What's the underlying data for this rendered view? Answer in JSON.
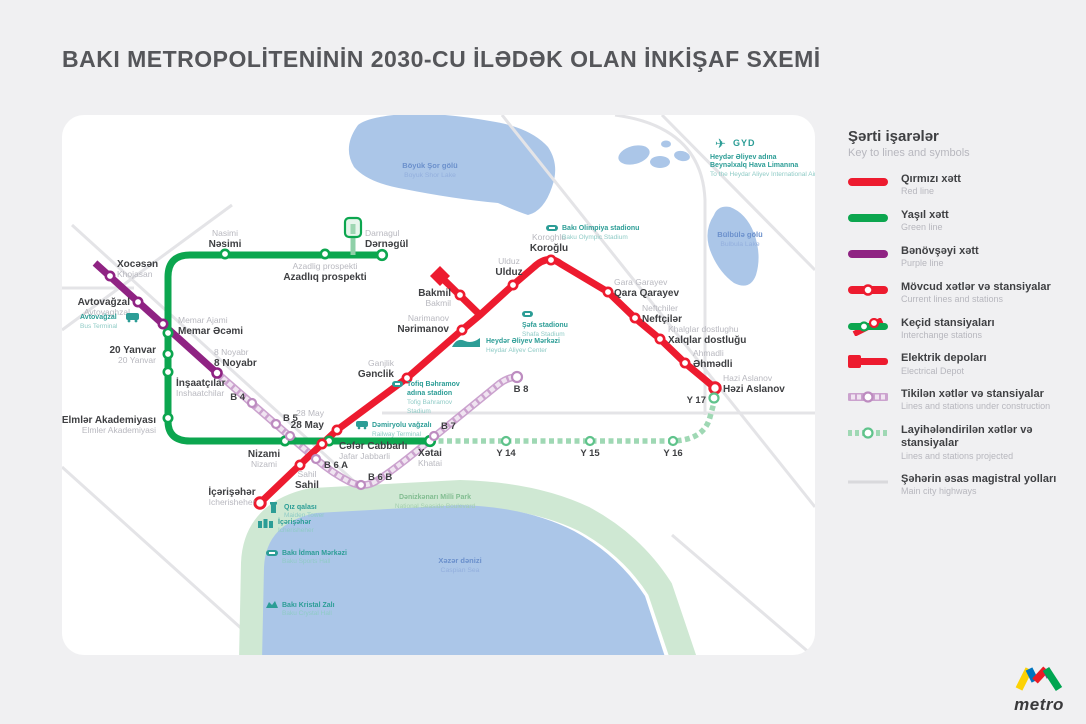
{
  "title": "BAKI METROPOLİTENİNİN 2030-CU İLƏDƏK OLAN İNKİŞAF SXEMİ",
  "colors": {
    "red_line": "#ed1b2f",
    "green_line": "#0ca64f",
    "purple_line": "#8f2383",
    "construction_line": "#cba2ce",
    "projected_line": "#9fd8b4",
    "highway": "#e4e4e7",
    "water": "#abc6e8",
    "park": "#cfe8d3",
    "landmark_teal": "#2c9d96"
  },
  "legend": {
    "title_az": "Şərti işarələr",
    "title_en": "Key to lines and symbols",
    "items": [
      {
        "az": "Qırmızı xətt",
        "en": "Red line"
      },
      {
        "az": "Yaşıl xətt",
        "en": "Green line"
      },
      {
        "az": "Bənövşəyi xətt",
        "en": "Purple line"
      },
      {
        "az": "Mövcud xətlər və stansiyalar",
        "en": "Current lines and stations"
      },
      {
        "az": "Keçid stansiyaları",
        "en": "Interchange stations"
      },
      {
        "az": "Elektrik depoları",
        "en": "Electrical Depot"
      },
      {
        "az": "Tikilən xətlər və stansiyalar",
        "en": "Lines and stations under construction"
      },
      {
        "az": "Layihələndirilən xətlər və stansiyalar",
        "en": "Lines and stations projected"
      },
      {
        "az": "Şəhərin əsas magistral yolları",
        "en": "Main city highways"
      }
    ]
  },
  "stations": {
    "nasimi": {
      "az": "Nəsimi",
      "en": "Nasimi"
    },
    "azadliq": {
      "az": "Azadlıq prospekti",
      "en": "Azadlig prospekti"
    },
    "darnagul": {
      "az": "Dərnəgül",
      "en": "Darnagul"
    },
    "memar": {
      "az": "Memar Əcəmi",
      "en": "Memar Ajami"
    },
    "yanvar20": {
      "az": "20 Yanvar",
      "en": "20 Yanvar"
    },
    "inshaatchilar": {
      "az": "İnşaatçılar",
      "en": "Inshaatchilar"
    },
    "elmler": {
      "az": "Elmlər Akademiyası",
      "en": "Elmler Akademiyasi"
    },
    "nizami": {
      "az": "Nizami",
      "en": "Nizami"
    },
    "may28": {
      "az": "28 May",
      "en": "28 May"
    },
    "khatai": {
      "az": "Xətai",
      "en": "Khatai"
    },
    "icherisheher": {
      "az": "İçərişəhər",
      "en": "Icherisheher"
    },
    "sahil": {
      "az": "Sahil",
      "en": "Sahil"
    },
    "jafar": {
      "az": "Cəfər Cabbarlı",
      "en": "Jafar Jabbarli"
    },
    "ganjlik": {
      "az": "Gənclik",
      "en": "Ganjlik"
    },
    "narimanov": {
      "az": "Nərimanov",
      "en": "Narimanov"
    },
    "bakmil": {
      "az": "Bakmil",
      "en": "Bakmil"
    },
    "ulduz": {
      "az": "Ulduz",
      "en": "Ulduz"
    },
    "koroglu": {
      "az": "Koroğlu",
      "en": "Koroghlu"
    },
    "qara": {
      "az": "Qara Qarayev",
      "en": "Gara Garayev"
    },
    "neftchiler": {
      "az": "Neftçilər",
      "en": "Neftchiler"
    },
    "khalglar": {
      "az": "Xalqlar dostluğu",
      "en": "Khalglar dostlughu"
    },
    "ahmadli": {
      "az": "Əhmədli",
      "en": "Ahmadli"
    },
    "hazi": {
      "az": "Həzi Aslanov",
      "en": "Hazi Aslanov"
    },
    "khojasan": {
      "az": "Xocəsən",
      "en": "Khojasan"
    },
    "avtovaghzal": {
      "az": "Avtovağzal",
      "en": "Avtovaghzal"
    },
    "noyabr8": {
      "az": "8 Noyabr",
      "en": "8 Noyabr"
    }
  },
  "construction_stations": {
    "b4": "B 4",
    "b5": "B 5",
    "b6a": "B 6 A",
    "b6b": "B 6 B",
    "b7": "B 7",
    "b8": "B 8"
  },
  "projected_stations": {
    "y14": "Y 14",
    "y15": "Y 15",
    "y16": "Y 16",
    "y17": "Y 17"
  },
  "landmarks": {
    "bus": {
      "az": "Avtovağzal",
      "en": "Bus Terminal"
    },
    "olympic": {
      "az": "Bakı Olimpiya stadionu",
      "en": "Baku Olympic Stadium"
    },
    "shafa": {
      "az": "Şəfa stadionu",
      "en": "Shafa Stadium"
    },
    "aliyev": {
      "az": "Heydər Əliyev Mərkəzi",
      "en": "Heydar Aliyev Center"
    },
    "tofig": {
      "lines_az": [
        "Tofiq Bəhramov",
        "adına stadion"
      ],
      "lines_en": [
        "Tofig Bahramov",
        "Stadium"
      ]
    },
    "railway": {
      "az": "Dəmiryolu vağzalı",
      "en": "Railway Terminal"
    },
    "maiden": {
      "az": "Qız qalası",
      "en": "Maiden Tower"
    },
    "icheri": {
      "az": "İçərişəhər",
      "en": "Icherisheher"
    },
    "sports": {
      "az": "Bakı İdman Mərkəzi",
      "en": "Baku Sports Hall"
    },
    "crystal": {
      "az": "Bakı Kristal Zalı",
      "en": "Baku Crystal Hall"
    }
  },
  "water": {
    "boyuk_shor": {
      "az": "Böyük Şor gölü",
      "en": "Boyuk Shor Lake"
    },
    "bulbula": {
      "az": "Bülbülə gölü",
      "en": "Bulbula Lake"
    },
    "caspian": {
      "az": "Xəzər dənizi",
      "en": "Caspian Sea"
    }
  },
  "park_label": {
    "az": "Dənizkənarı Milli Park",
    "en": "National Seaside Boulevard"
  },
  "airport": {
    "code": "GYD",
    "line1": "Heydər Əliyev adına",
    "line2": "Beynəlxalq Hava Limanına",
    "line3": "To the Heydar Aliyev International Airport"
  },
  "logo": {
    "word": "metro"
  }
}
